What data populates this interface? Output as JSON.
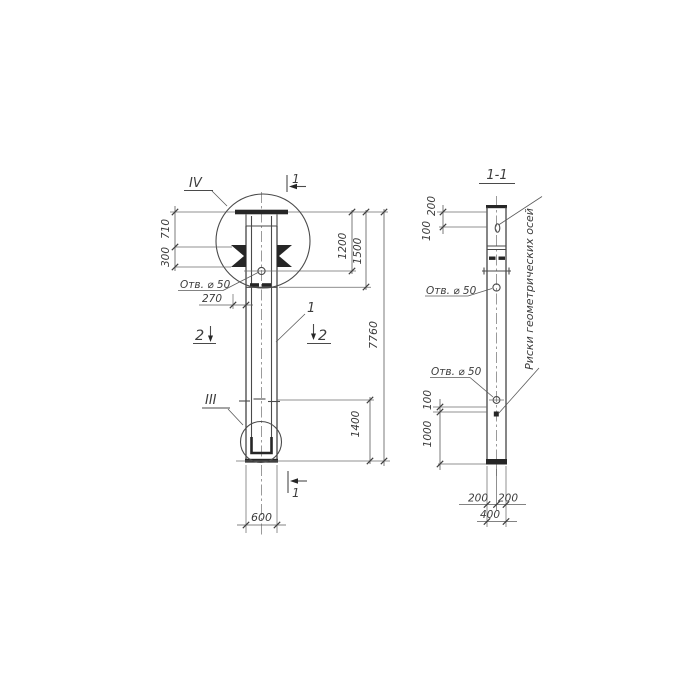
{
  "meta": {
    "background_color": "#ffffff",
    "ink_color": "#3c3c3c",
    "drawing_type": "hand-drawn structural column drawing"
  },
  "front_view": {
    "detail_top_label": "IV",
    "detail_bottom_label": "III",
    "section1_top_label": "1",
    "section1_bottom_label": "1",
    "section2_left_label": "2",
    "section2_right_label": "2",
    "part_ref_label": "1",
    "hole_note": "Отв. ⌀ 50",
    "dims": {
      "d710": "710",
      "d300": "300",
      "d270": "270",
      "d1200": "1200",
      "d1500": "1500",
      "d7760": "7760",
      "d1400": "1400",
      "d600": "600"
    }
  },
  "section_view": {
    "title": "1-1",
    "hole_note_upper": "Отв. ⌀ 50",
    "hole_note_lower": "Отв. ⌀ 50",
    "axes_note": "Риски геометрических осей",
    "dims": {
      "d200_top": "200",
      "d100_top": "100",
      "d100_low": "100",
      "d1000": "1000",
      "d200_left": "200",
      "d200_right": "200",
      "d400": "400"
    }
  }
}
